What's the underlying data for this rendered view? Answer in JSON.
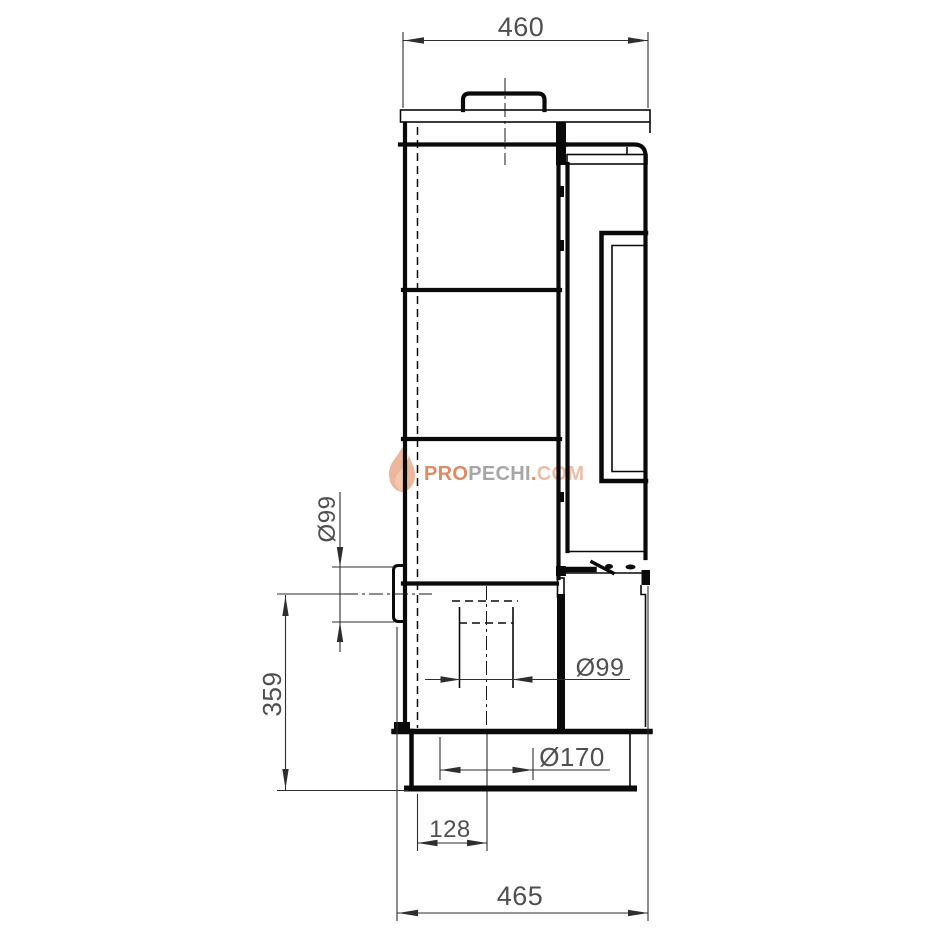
{
  "drawing": {
    "line_color": "#0a0a0a",
    "dim_line_color": "#2e2e2e",
    "dim_text_color": "#4f4f4f",
    "background": "#ffffff"
  },
  "dimensions": {
    "top_width": "460",
    "overall_depth": "465",
    "rear_flue_center_height": "359",
    "rear_flue_diameter": "Ø99",
    "bottom_flue_diameter": "Ø99",
    "base_opening_diameter": "Ø170",
    "flue_center_offset": "128"
  },
  "watermark": {
    "pro": "PRO",
    "pechi": "PECHI",
    "dot": ".",
    "com": "COM",
    "orange": "#d87c50",
    "gray": "#9a9a9a",
    "light_orange": "#e9b49a",
    "flame_outer": "#e08a5e",
    "flame_inner": "#f3c3a6"
  }
}
